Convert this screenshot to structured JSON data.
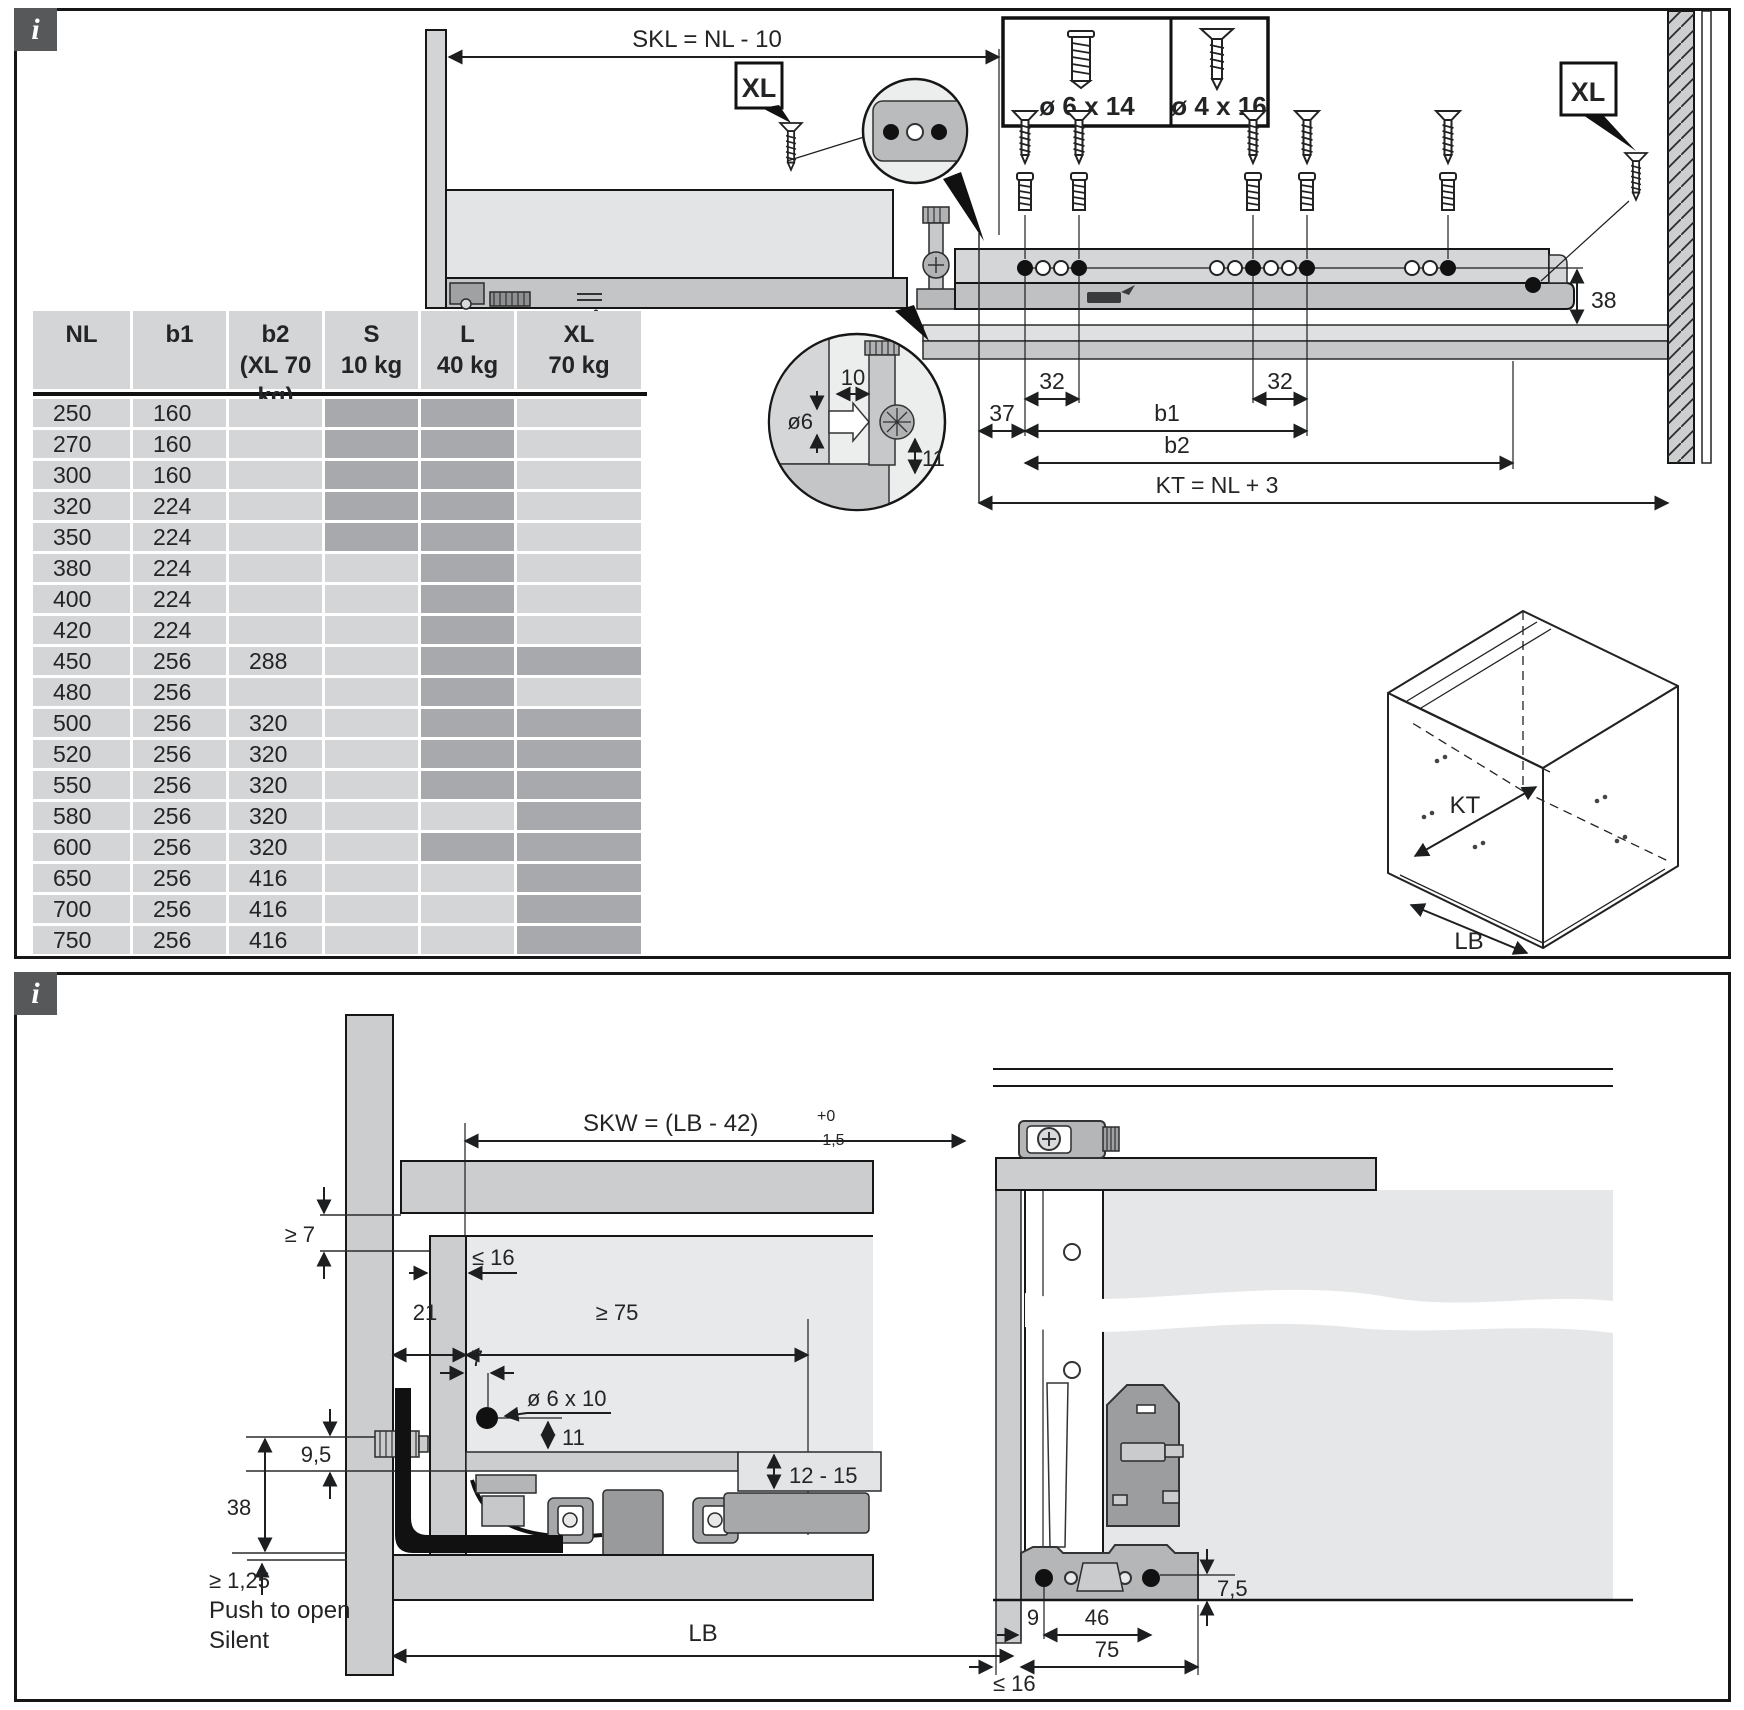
{
  "theme": {
    "cell_light": "#d3d5d7",
    "cell_dark": "#a7a9ac",
    "panel_gray": "#cbcdcf",
    "light_gray": "#e6e7e8",
    "badge_gray": "#57585a"
  },
  "top_panel": {
    "info_icon": "i",
    "table": {
      "headers": [
        {
          "l1": "NL",
          "l2": ""
        },
        {
          "l1": "b1",
          "l2": ""
        },
        {
          "l1": "b2",
          "l2": "(XL 70 kg)"
        },
        {
          "l1": "S",
          "l2": "10 kg"
        },
        {
          "l1": "L",
          "l2": "40 kg"
        },
        {
          "l1": "XL",
          "l2": "70 kg"
        }
      ],
      "rows": [
        {
          "nl": "250",
          "b1": "160",
          "b2": "",
          "s": true,
          "l": true,
          "xl": false
        },
        {
          "nl": "270",
          "b1": "160",
          "b2": "",
          "s": true,
          "l": true,
          "xl": false
        },
        {
          "nl": "300",
          "b1": "160",
          "b2": "",
          "s": true,
          "l": true,
          "xl": false
        },
        {
          "nl": "320",
          "b1": "224",
          "b2": "",
          "s": true,
          "l": true,
          "xl": false
        },
        {
          "nl": "350",
          "b1": "224",
          "b2": "",
          "s": true,
          "l": true,
          "xl": false
        },
        {
          "nl": "380",
          "b1": "224",
          "b2": "",
          "s": false,
          "l": true,
          "xl": false
        },
        {
          "nl": "400",
          "b1": "224",
          "b2": "",
          "s": false,
          "l": true,
          "xl": false
        },
        {
          "nl": "420",
          "b1": "224",
          "b2": "",
          "s": false,
          "l": true,
          "xl": false
        },
        {
          "nl": "450",
          "b1": "256",
          "b2": "288",
          "s": false,
          "l": true,
          "xl": true
        },
        {
          "nl": "480",
          "b1": "256",
          "b2": "",
          "s": false,
          "l": true,
          "xl": false
        },
        {
          "nl": "500",
          "b1": "256",
          "b2": "320",
          "s": false,
          "l": true,
          "xl": true
        },
        {
          "nl": "520",
          "b1": "256",
          "b2": "320",
          "s": false,
          "l": true,
          "xl": true
        },
        {
          "nl": "550",
          "b1": "256",
          "b2": "320",
          "s": false,
          "l": true,
          "xl": true
        },
        {
          "nl": "580",
          "b1": "256",
          "b2": "320",
          "s": false,
          "l": false,
          "xl": true
        },
        {
          "nl": "600",
          "b1": "256",
          "b2": "320",
          "s": false,
          "l": true,
          "xl": true
        },
        {
          "nl": "650",
          "b1": "256",
          "b2": "416",
          "s": false,
          "l": false,
          "xl": true
        },
        {
          "nl": "700",
          "b1": "256",
          "b2": "416",
          "s": false,
          "l": false,
          "xl": true
        },
        {
          "nl": "750",
          "b1": "256",
          "b2": "416",
          "s": false,
          "l": false,
          "xl": true
        }
      ]
    },
    "drawer_view": {
      "skl_formula": "SKL = NL - 10",
      "xl_label": "XL"
    },
    "rail_view": {
      "screw_box": {
        "left": "ø 6 x 14",
        "right": "ø 4 x 16"
      },
      "xl_label": "XL",
      "dim_38": "38",
      "dim_37": "37",
      "dim_32_left": "32",
      "dim_32_right": "32",
      "dim_b1": "b1",
      "dim_b2": "b2",
      "kt_formula": "KT = NL + 3"
    },
    "detail_view": {
      "dim_10": "10",
      "dim_dia6": "ø6",
      "dim_11": "11"
    },
    "cabinet_view": {
      "kt": "KT",
      "lb": "LB"
    }
  },
  "bottom_panel": {
    "info_icon": "i",
    "side_view": {
      "skw_formula": "SKW = (LB - 42)",
      "skw_tol_plus": "+0",
      "skw_tol_minus": "-1,5",
      "dim_ge7": "≥ 7",
      "dim_le16": "≤ 16",
      "dim_21": "21",
      "dim_ge75": "≥ 75",
      "dim_7": "7",
      "hole_label": "ø 6 x 10",
      "dim_11": "11",
      "dim_9_5": "9,5",
      "dim_38": "38",
      "dim_ge125": "≥ 1,25",
      "feature_1": "Push to open",
      "feature_2": "Silent",
      "dim_12_15": "12 - 15",
      "dim_lb": "LB"
    },
    "rear_view": {
      "dim_7_5": "7,5",
      "dim_9": "9",
      "dim_46": "46",
      "dim_75": "75",
      "dim_le16": "≤ 16"
    }
  }
}
